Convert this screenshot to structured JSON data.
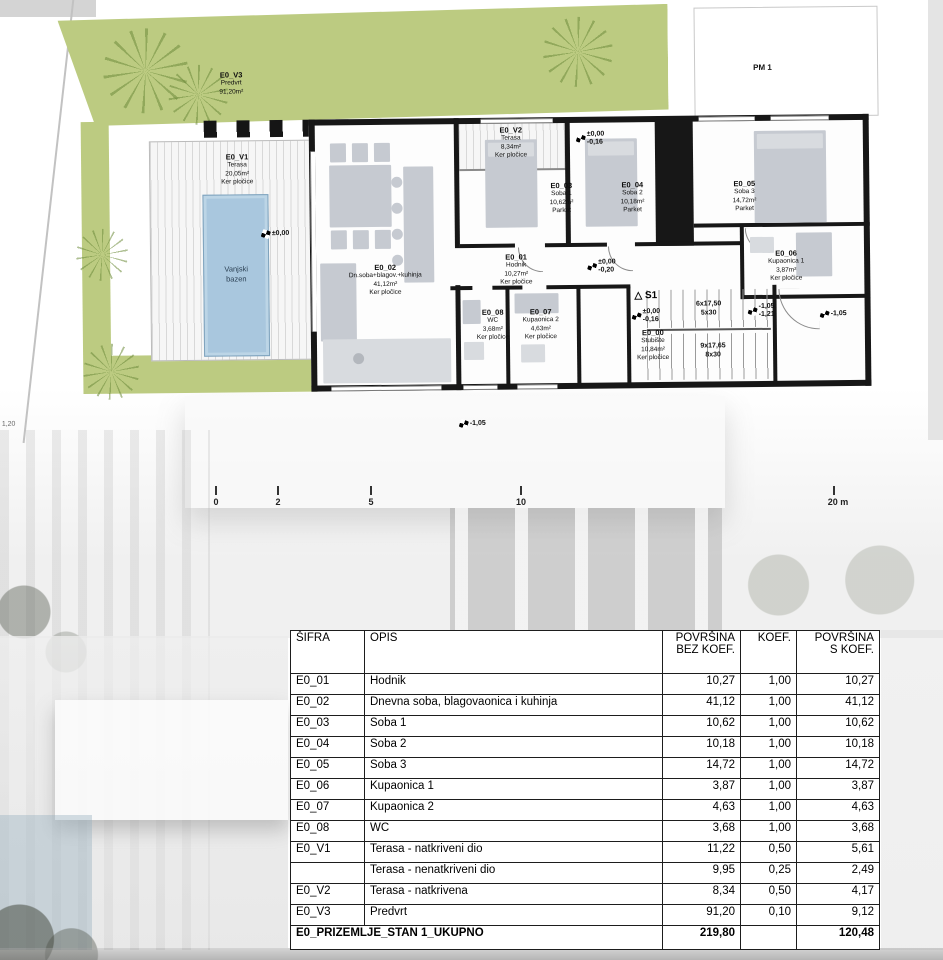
{
  "plan": {
    "garden": {
      "code": "E0_V3",
      "name": "Predvrt",
      "area": "91,20m²"
    },
    "parking_label": "PM 1",
    "pool_label": "Vanjski\nbazen",
    "rooms": [
      {
        "code": "E0_V1",
        "name": "Terasa",
        "area": "20,05m²",
        "floor": "Ker pločice"
      },
      {
        "code": "E0_V2",
        "name": "Terasa",
        "area": "8,34m²",
        "floor": "Ker pločice"
      },
      {
        "code": "E0_02",
        "name": "Dn.soba+blagov.+kuhinja",
        "area": "41,12m²",
        "floor": "Ker pločice"
      },
      {
        "code": "E0_03",
        "name": "Soba 1",
        "area": "10,62m²",
        "floor": "Parket"
      },
      {
        "code": "E0_04",
        "name": "Soba 2",
        "area": "10,18m²",
        "floor": "Parket"
      },
      {
        "code": "E0_05",
        "name": "Soba 3",
        "area": "14,72m²",
        "floor": "Parket"
      },
      {
        "code": "E0_01",
        "name": "Hodnik",
        "area": "10,27m²",
        "floor": "Ker pločice"
      },
      {
        "code": "E0_06",
        "name": "Kupaonica 1",
        "area": "3,87m²",
        "floor": "Ker pločice"
      },
      {
        "code": "E0_08",
        "name": "WC",
        "area": "3,68m²",
        "floor": "Ker pločice"
      },
      {
        "code": "E0_07",
        "name": "Kupaonica 2",
        "area": "4,63m²",
        "floor": "Ker pločice"
      },
      {
        "code": "E0_00",
        "name": "Stubište",
        "area": "10,84m²",
        "floor": "Ker pločice"
      }
    ],
    "levels": {
      "terrace": "±0,00",
      "entry": [
        "±0,00",
        "-0,16"
      ],
      "hall": [
        "±0,00",
        "-0,20"
      ],
      "stairs_top": [
        "±0,00",
        "-0,16"
      ],
      "stairs_mid": [
        "-1,05",
        "-1,21"
      ],
      "stairs_right": "-1,05",
      "site": "-1,05",
      "left_note": "1,20"
    },
    "stairs": {
      "marker": "△ S1",
      "run1a": "6x17,50",
      "run1b": "5x30",
      "run2a": "9x17,65",
      "run2b": "8x30"
    },
    "scalebar": [
      "0",
      "2",
      "5",
      "10",
      "20 m"
    ]
  },
  "table": {
    "headers": [
      "ŠIFRA",
      "OPIS",
      "POVRŠINA\nBEZ KOEF.",
      "KOEF.",
      "POVRŠINA\nS KOEF."
    ],
    "rows": [
      {
        "code": "E0_01",
        "opis": "Hodnik",
        "bez": "10,27",
        "koef": "1,00",
        "s": "10,27"
      },
      {
        "code": "E0_02",
        "opis": "Dnevna soba, blagovaonica i kuhinja",
        "bez": "41,12",
        "koef": "1,00",
        "s": "41,12"
      },
      {
        "code": "E0_03",
        "opis": "Soba 1",
        "bez": "10,62",
        "koef": "1,00",
        "s": "10,62"
      },
      {
        "code": "E0_04",
        "opis": "Soba 2",
        "bez": "10,18",
        "koef": "1,00",
        "s": "10,18"
      },
      {
        "code": "E0_05",
        "opis": "Soba 3",
        "bez": "14,72",
        "koef": "1,00",
        "s": "14,72"
      },
      {
        "code": "E0_06",
        "opis": "Kupaonica 1",
        "bez": "3,87",
        "koef": "1,00",
        "s": "3,87"
      },
      {
        "code": "E0_07",
        "opis": "Kupaonica 2",
        "bez": "4,63",
        "koef": "1,00",
        "s": "4,63"
      },
      {
        "code": "E0_08",
        "opis": "WC",
        "bez": "3,68",
        "koef": "1,00",
        "s": "3,68"
      },
      {
        "code": "E0_V1",
        "opis": "Terasa - natkriveni dio",
        "bez": "11,22",
        "koef": "0,50",
        "s": "5,61"
      },
      {
        "code": "",
        "opis": "Terasa - nenatkriveni dio",
        "bez": "9,95",
        "koef": "0,25",
        "s": "2,49"
      },
      {
        "code": "E0_V2",
        "opis": "Terasa - natkrivena",
        "bez": "8,34",
        "koef": "0,50",
        "s": "4,17"
      },
      {
        "code": "E0_V3",
        "opis": "Predvrt",
        "bez": "91,20",
        "koef": "0,10",
        "s": "9,12"
      }
    ],
    "footer": {
      "label": "E0_PRIZEMLJE_STAN 1_UKUPNO",
      "bez": "219,80",
      "koef": "",
      "s": "120,48"
    }
  }
}
